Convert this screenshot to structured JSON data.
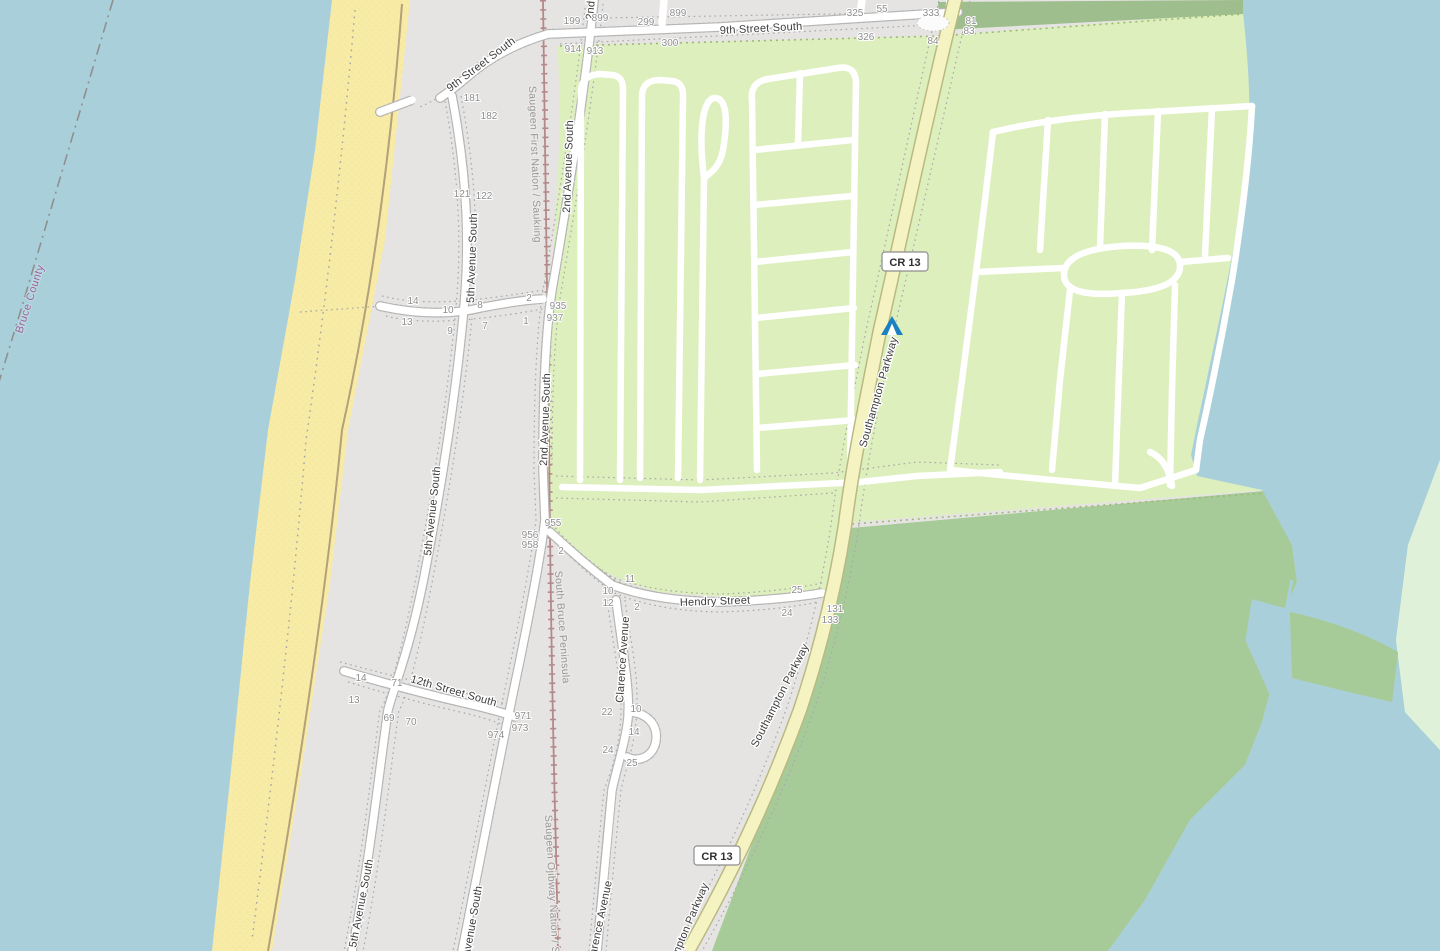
{
  "map": {
    "type": "openstreetmap-style tile view",
    "area": "Southampton / Saugeen shoreline",
    "colors": {
      "water": "#a9d0da",
      "beach_sand": "#f7eba6",
      "land_gray": "#e6e4e2",
      "campground_green": "#ddefbc",
      "nature_reserve_green": "#a7cb98",
      "wetland_mint": "#e0f1da",
      "top_wood_strip": "#9fbe8d",
      "road_white": "#ffffff",
      "parkway_yellow": "#f6f3c2",
      "railway_brown": "#b48989",
      "boundary_purple": "#9d5f9d",
      "housenumber_gray": "#8d8d8d",
      "tree_glyph": "#7e9c68",
      "campsite_blue": "#1b80c0"
    }
  },
  "labels": [
    {
      "t": "9th Street South",
      "x": 720,
      "y": 34,
      "r": -3,
      "c": "street",
      "n": "street-label-9th-street-south"
    },
    {
      "t": "9th Street South",
      "x": 450,
      "y": 92,
      "r": -37,
      "c": "street",
      "n": "street-label-9th-street-south"
    },
    {
      "t": "2nd Avenue South",
      "x": 570,
      "y": 213,
      "r": -88,
      "c": "street",
      "n": "street-label-2nd-avenue-south"
    },
    {
      "t": "2nd Avenue South",
      "x": 593,
      "y": 20,
      "r": -85,
      "c": "street",
      "n": "street-label-2nd-avenue-south"
    },
    {
      "t": "2nd Avenue South",
      "x": 547,
      "y": 466,
      "r": -88,
      "c": "street",
      "n": "street-label-2nd-avenue-south"
    },
    {
      "t": "2nd Avenue South",
      "x": 466,
      "y": 978,
      "r": -80,
      "c": "street",
      "n": "street-label-2nd-avenue-south"
    },
    {
      "t": "5th Avenue South",
      "x": 474,
      "y": 303,
      "r": -88,
      "c": "street",
      "n": "street-label-5th-avenue-south"
    },
    {
      "t": "5th Avenue South",
      "x": 431,
      "y": 556,
      "r": -84,
      "c": "street",
      "n": "street-label-5th-avenue-south"
    },
    {
      "t": "5th Avenue South",
      "x": 356,
      "y": 948,
      "r": -79,
      "c": "street",
      "n": "street-label-5th-avenue-south"
    },
    {
      "t": "12th Street South",
      "x": 410,
      "y": 682,
      "r": 16,
      "c": "street",
      "n": "street-label-12th-street-south"
    },
    {
      "t": "Hendry Street",
      "x": 680,
      "y": 606,
      "r": -2,
      "c": "street",
      "n": "street-label-hendry-street"
    },
    {
      "t": "Clarence Avenue",
      "x": 623,
      "y": 703,
      "r": -86,
      "c": "street",
      "n": "street-label-clarence-avenue"
    },
    {
      "t": "Clarence Avenue",
      "x": 594,
      "y": 966,
      "r": -78,
      "c": "street",
      "n": "street-label-clarence-avenue"
    },
    {
      "t": "Southampton Parkway",
      "x": 866,
      "y": 448,
      "r": -74,
      "c": "street",
      "n": "street-label-southampton-parkway"
    },
    {
      "t": "Southampton Parkway",
      "x": 757,
      "y": 748,
      "r": -63,
      "c": "street",
      "n": "street-label-southampton-parkway"
    },
    {
      "t": "Southampton Parkway",
      "x": 664,
      "y": 990,
      "r": -67,
      "c": "street",
      "n": "street-label-southampton-parkway"
    },
    {
      "t": "Saugeen First Nation / Saukiing",
      "x": 529,
      "y": 86,
      "r": 88,
      "c": "rail",
      "n": "admin-label-saugeen-first-nation"
    },
    {
      "t": "South Bruce Peninsula",
      "x": 555,
      "y": 571,
      "r": 86,
      "c": "rail",
      "n": "admin-label-south-bruce-peninsula"
    },
    {
      "t": "Saugeen Ojibway Nation / Saukiing",
      "x": 545,
      "y": 815,
      "r": 87,
      "c": "rail",
      "n": "admin-label-saugeen-ojibway-nation"
    },
    {
      "t": "Bruce County",
      "x": 22,
      "y": 334,
      "r": -72,
      "c": "boundary",
      "n": "boundary-label-bruce-county"
    }
  ],
  "house_numbers": [
    [
      "199",
      572,
      24
    ],
    [
      "899",
      600,
      21
    ],
    [
      "299",
      646,
      25
    ],
    [
      "899",
      678,
      16
    ],
    [
      "325",
      855,
      16
    ],
    [
      "55",
      882,
      12
    ],
    [
      "333",
      931,
      16
    ],
    [
      "914",
      573,
      52
    ],
    [
      "913",
      595,
      54
    ],
    [
      "300",
      670,
      46
    ],
    [
      "326",
      866,
      40
    ],
    [
      "84",
      933,
      44
    ],
    [
      "81",
      971,
      24
    ],
    [
      "83",
      969,
      34
    ],
    [
      "181",
      472,
      101
    ],
    [
      "182",
      489,
      119
    ],
    [
      "121",
      462,
      197
    ],
    [
      "122",
      484,
      199
    ],
    [
      "14",
      413,
      304
    ],
    [
      "10",
      448,
      313
    ],
    [
      "8",
      480,
      308
    ],
    [
      "2",
      529,
      301
    ],
    [
      "13",
      407,
      325
    ],
    [
      "9",
      450,
      334
    ],
    [
      "7",
      485,
      329
    ],
    [
      "1",
      526,
      324
    ],
    [
      "935",
      558,
      309
    ],
    [
      "937",
      555,
      321
    ],
    [
      "955",
      553,
      526
    ],
    [
      "956",
      530,
      538
    ],
    [
      "958",
      530,
      548
    ],
    [
      "2",
      561,
      554
    ],
    [
      "11",
      630,
      582
    ],
    [
      "10",
      608,
      594
    ],
    [
      "12",
      608,
      606
    ],
    [
      "2",
      637,
      610
    ],
    [
      "25",
      797,
      593
    ],
    [
      "24",
      787,
      616
    ],
    [
      "131",
      835,
      612
    ],
    [
      "133",
      830,
      623
    ],
    [
      "14",
      361,
      681
    ],
    [
      "71",
      397,
      686
    ],
    [
      "13",
      354,
      703
    ],
    [
      "69",
      389,
      721
    ],
    [
      "70",
      411,
      725
    ],
    [
      "971",
      523,
      719
    ],
    [
      "973",
      520,
      731
    ],
    [
      "974",
      496,
      738
    ],
    [
      "22",
      607,
      715
    ],
    [
      "10",
      636,
      712
    ],
    [
      "14",
      634,
      735
    ],
    [
      "24",
      608,
      753
    ],
    [
      "25",
      632,
      766
    ]
  ],
  "shields": [
    {
      "t": "CR 13",
      "x": 905,
      "y": 262
    },
    {
      "t": "CR 13",
      "x": 717,
      "y": 856
    }
  ],
  "poi": {
    "campsite": {
      "icon": "tent-icon",
      "x": 892,
      "y": 326
    }
  }
}
